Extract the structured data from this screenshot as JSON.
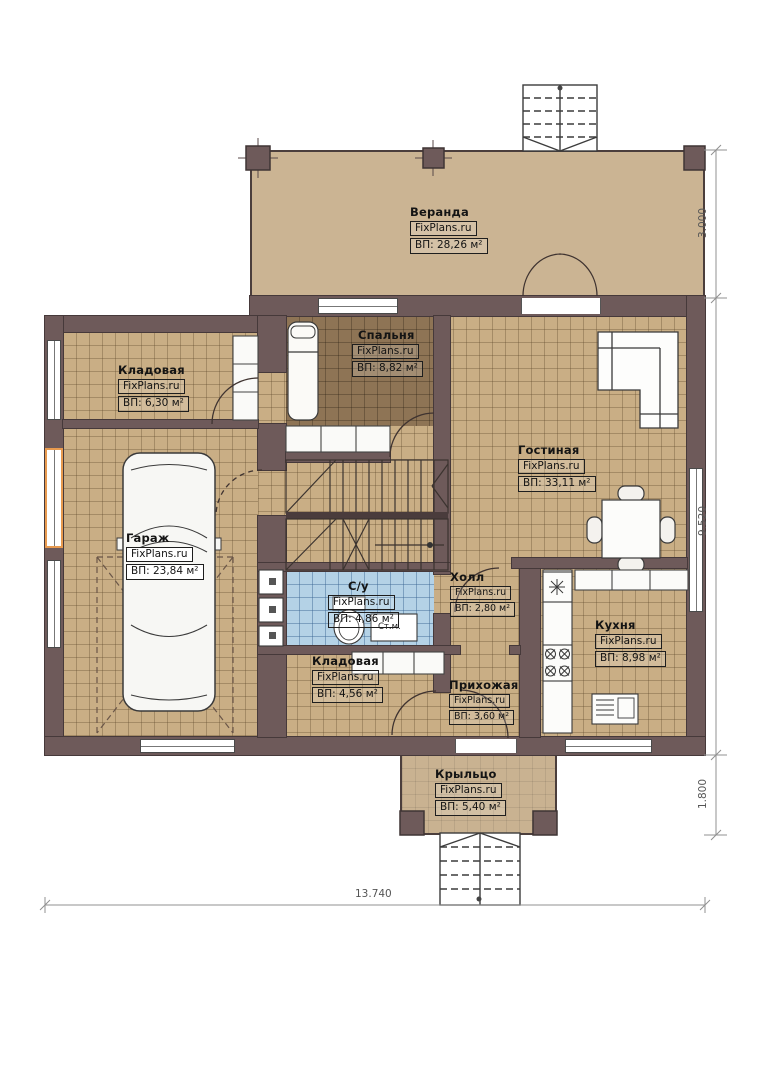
{
  "brand": "FixPlans.ru",
  "rooms": [
    {
      "id": "veranda",
      "name": "Веранда",
      "area": "ВП: 28,26 м²"
    },
    {
      "id": "storage-top",
      "name": "Кладовая",
      "area": "ВП: 6,30 м²"
    },
    {
      "id": "bedroom",
      "name": "Спальня",
      "area": "ВП: 8,82 м²"
    },
    {
      "id": "living",
      "name": "Гостиная",
      "area": "ВП: 33,11 м²"
    },
    {
      "id": "garage",
      "name": "Гараж",
      "area": "ВП: 23,84 м²"
    },
    {
      "id": "bathroom",
      "name": "С/у",
      "area": "ВП: 4,86 м²"
    },
    {
      "id": "hall",
      "name": "Холл",
      "area": "ВП: 2,80 м²"
    },
    {
      "id": "kitchen",
      "name": "Кухня",
      "area": "ВП: 8,98 м²"
    },
    {
      "id": "storage-bottom",
      "name": "Кладовая",
      "area": "ВП: 4,56 м²"
    },
    {
      "id": "entry",
      "name": "Прихожая",
      "area": "ВП: 3,60 м²"
    },
    {
      "id": "porch",
      "name": "Крыльцо",
      "area": "ВП: 5,40 м²"
    }
  ],
  "annotations": {
    "washing_machine": "Ст.м."
  },
  "dimensions": {
    "veranda_depth": "3.000",
    "house_depth": "9.520",
    "porch_depth": "1.800",
    "total_width": "13.740"
  },
  "colors": {
    "wall": "#6e5a5a",
    "floor_tan": "#c9ae85",
    "floor_bedroom": "#8e7455",
    "floor_bathroom": "#b4d2e6",
    "veranda": "#cbb493",
    "window_highlight": "#e89a4e"
  }
}
